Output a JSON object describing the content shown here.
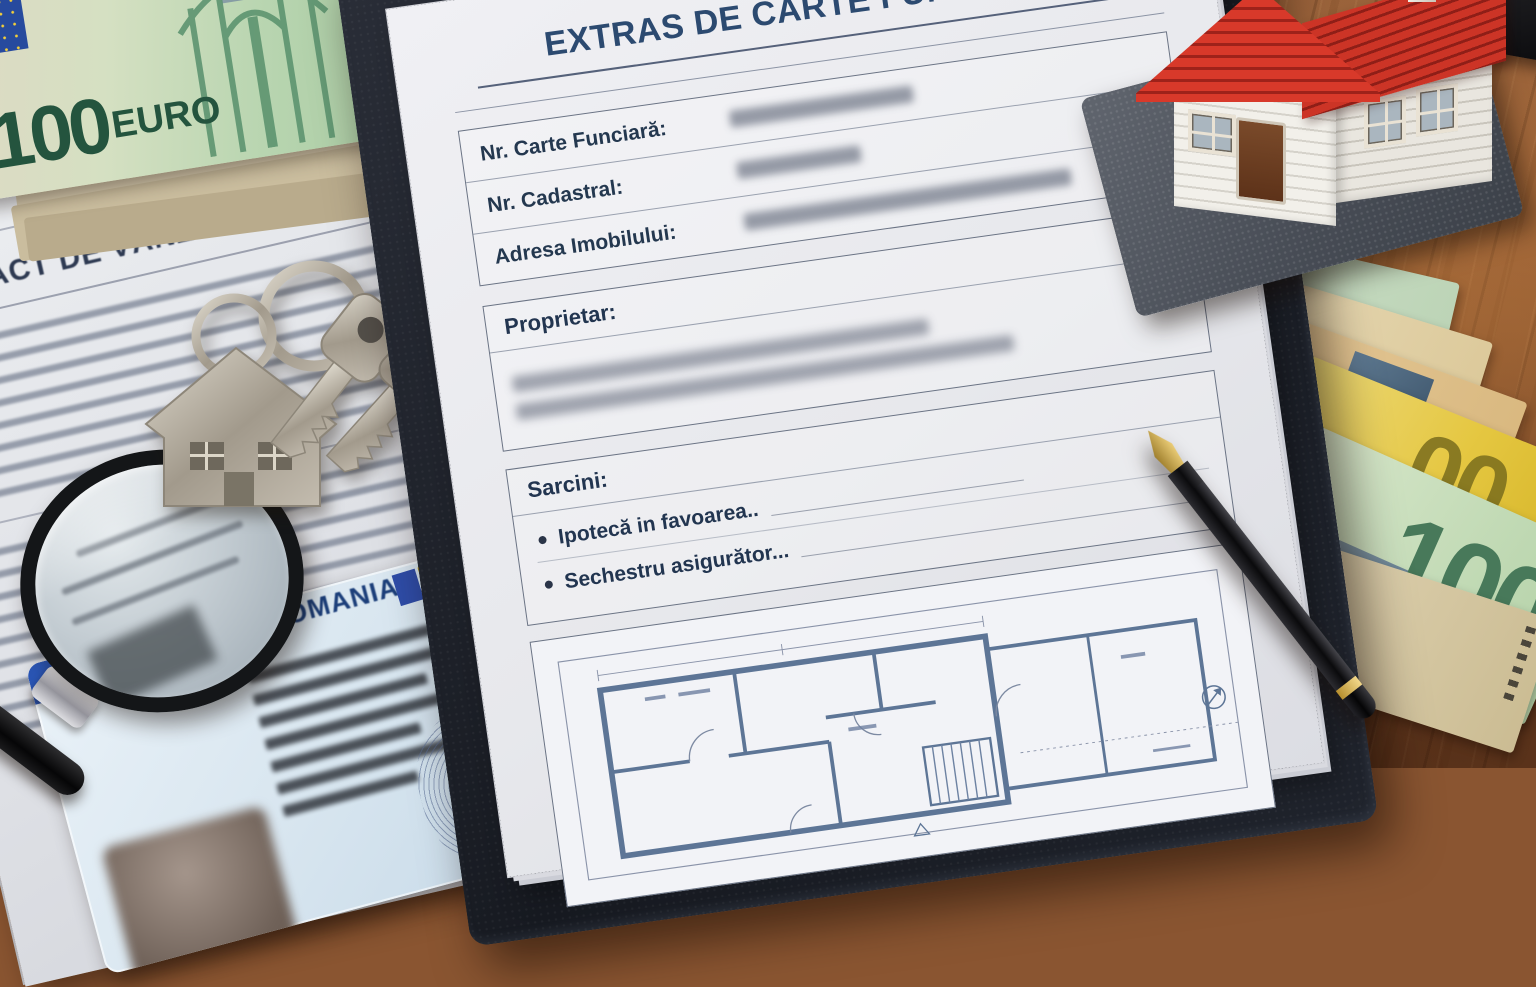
{
  "registry_document": {
    "title": "EXTRAS DE CARTE FUNCIARĂ",
    "fields": [
      {
        "label": "Nr. Carte Funciară:",
        "value_blurred": true
      },
      {
        "label": "Nr. Cadastral:",
        "value_blurred": true
      },
      {
        "label": "Adresa Imobilului:",
        "value_blurred": true
      }
    ],
    "owner_section": {
      "label": "Proprietar:",
      "value_blurred": true,
      "blurred_lines": 2
    },
    "charges_section": {
      "label": "Sarcini:",
      "items": [
        {
          "text": "Ipotecă in favoarea.."
        },
        {
          "text": "Sechestru asigurător..."
        }
      ]
    },
    "floor_plan_present": true
  },
  "contract_document": {
    "title": "CONTRACT DE VÂNZARE-CUMPĂRARE"
  },
  "id_card": {
    "country_label": "ROMANIA",
    "band_text": "ENOELIF NOLE",
    "flag_colors": [
      "#2f4da8",
      "#f2c51d",
      "#c3392b"
    ]
  },
  "banknotes": {
    "top_left_note": {
      "denomination": "100",
      "currency_word": "EURO"
    },
    "right_fan_green_note": {
      "denomination": "100"
    },
    "right_fan_yellow_note": {
      "visible_digits": "00"
    },
    "right_fan_orange_note": {
      "visible_digits": "00"
    }
  },
  "colors": {
    "title_blue": "#2c4a70",
    "paper": "#e9e9ee",
    "clipboard_leather": "#1e222a",
    "wood_brown": "#8a5531",
    "plan_line_blue": "#5d7596",
    "roof_red": "#c7352a"
  }
}
